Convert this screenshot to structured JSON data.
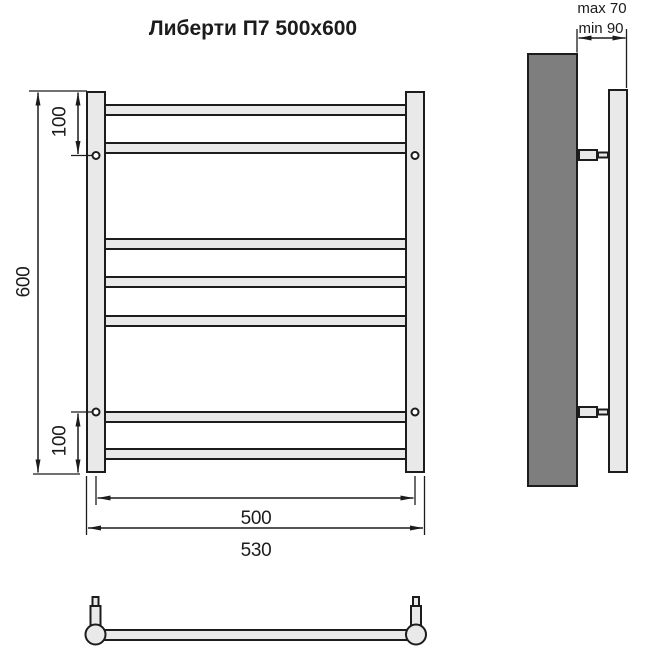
{
  "title": "Либерти П7 500x600",
  "dimensions": {
    "height": "600",
    "top_hole_offset": "100",
    "bottom_hole_offset": "100",
    "mounting_width": "500",
    "overall_width": "530",
    "wall_clearance_max": "max 70",
    "wall_clearance_min": "min 90"
  },
  "colors": {
    "line": "#1c1c1c",
    "part": "#e9e9e9",
    "wall": "#7e7e7e",
    "hole": "#ffffff",
    "bg": "#ffffff"
  }
}
